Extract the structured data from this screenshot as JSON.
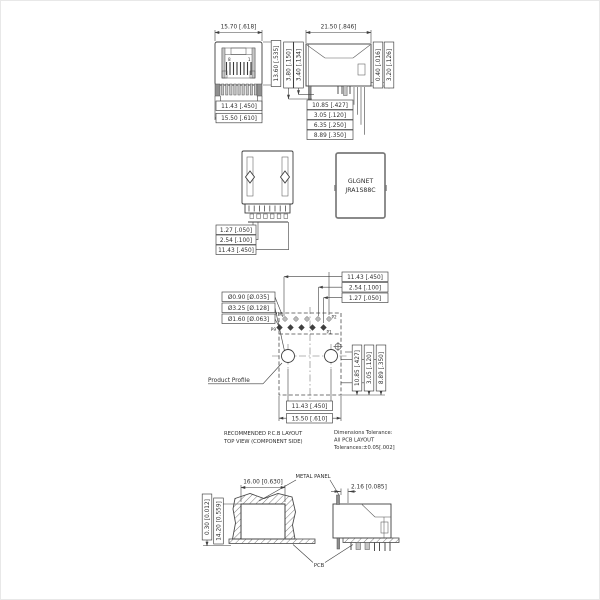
{
  "drawing": {
    "colors": {
      "line": "#3e3e3e",
      "hatch": "#6e6e6e",
      "background": "#ffffff",
      "shading": "#c6c6c6"
    },
    "front_view": {
      "dim_width": "15.70 [.618]",
      "dim_height": "13.60 [.535]",
      "dim_contact_span": "11.43 [.450]",
      "dim_base_width": "15.50 [.610]",
      "pin8_label": "8",
      "pin1_label": "1"
    },
    "side_view": {
      "dim_depth": "21.50 [.846]",
      "dim_leg_long": "3.80 [.150]",
      "dim_leg_short": "3.40 [.134]",
      "dim_tab": "0.40 [.016]",
      "dim_standoff": "3.20 [.126]",
      "dim_pin_row1": "10.85 [.427]",
      "dim_pin_row2": "3.05 [.120]",
      "dim_pin_row3": "6.35 [.250]",
      "dim_pin_row4": "8.89 [.350]"
    },
    "rear_view": {
      "dim_half_pitch": "1.27 [.050]",
      "dim_pitch": "2.54 [.100]",
      "dim_span": "11.43 [.450]"
    },
    "top_view": {
      "brand": "GLGNET",
      "model": "JRA1S88C"
    },
    "pcb_layout": {
      "hole_small": "Ø0.90 [Ø.035]",
      "hole_post": "Ø3.25 [Ø.128]",
      "hole_large": "Ø1.60 [Ø.063]",
      "dim_top_span": "11.43 [.450]",
      "dim_top_pitch": "2.54 [.100]",
      "dim_top_offset": "1.27 [.050]",
      "dim_right_1": "10.85 [.427]",
      "dim_right_2": "3.05 [.120]",
      "dim_right_3": "8.89 [.350]",
      "dim_bottom_posts": "11.43 [.450]",
      "dim_bottom_width": "15.50 [.610]",
      "product_profile": "Product Profile",
      "pin_p10": "P10",
      "pin_p2": "P2",
      "pin_p9": "P9",
      "pin_p1": "P1",
      "caption_line1": "RECOMMENDED P.C.B LAYOUT",
      "caption_line2": "TOP VIEW (COMPONENT SIDE)",
      "tolerance_line1": "Dimensions Tolerance:",
      "tolerance_line2": "All PCB LAYOUT",
      "tolerance_line3": "Tolerances:±0.05[.002]"
    },
    "panel_cutout": {
      "dim_width": "16.00 [0.630]",
      "dim_gap": "0.30 [0.012]",
      "dim_height": "14.20 [0.559]",
      "label_metal_panel": "METAL PANEL",
      "label_pcb": "PCB"
    },
    "panel_side": {
      "dim_panel_offset": "2.16 [0.085]"
    }
  }
}
